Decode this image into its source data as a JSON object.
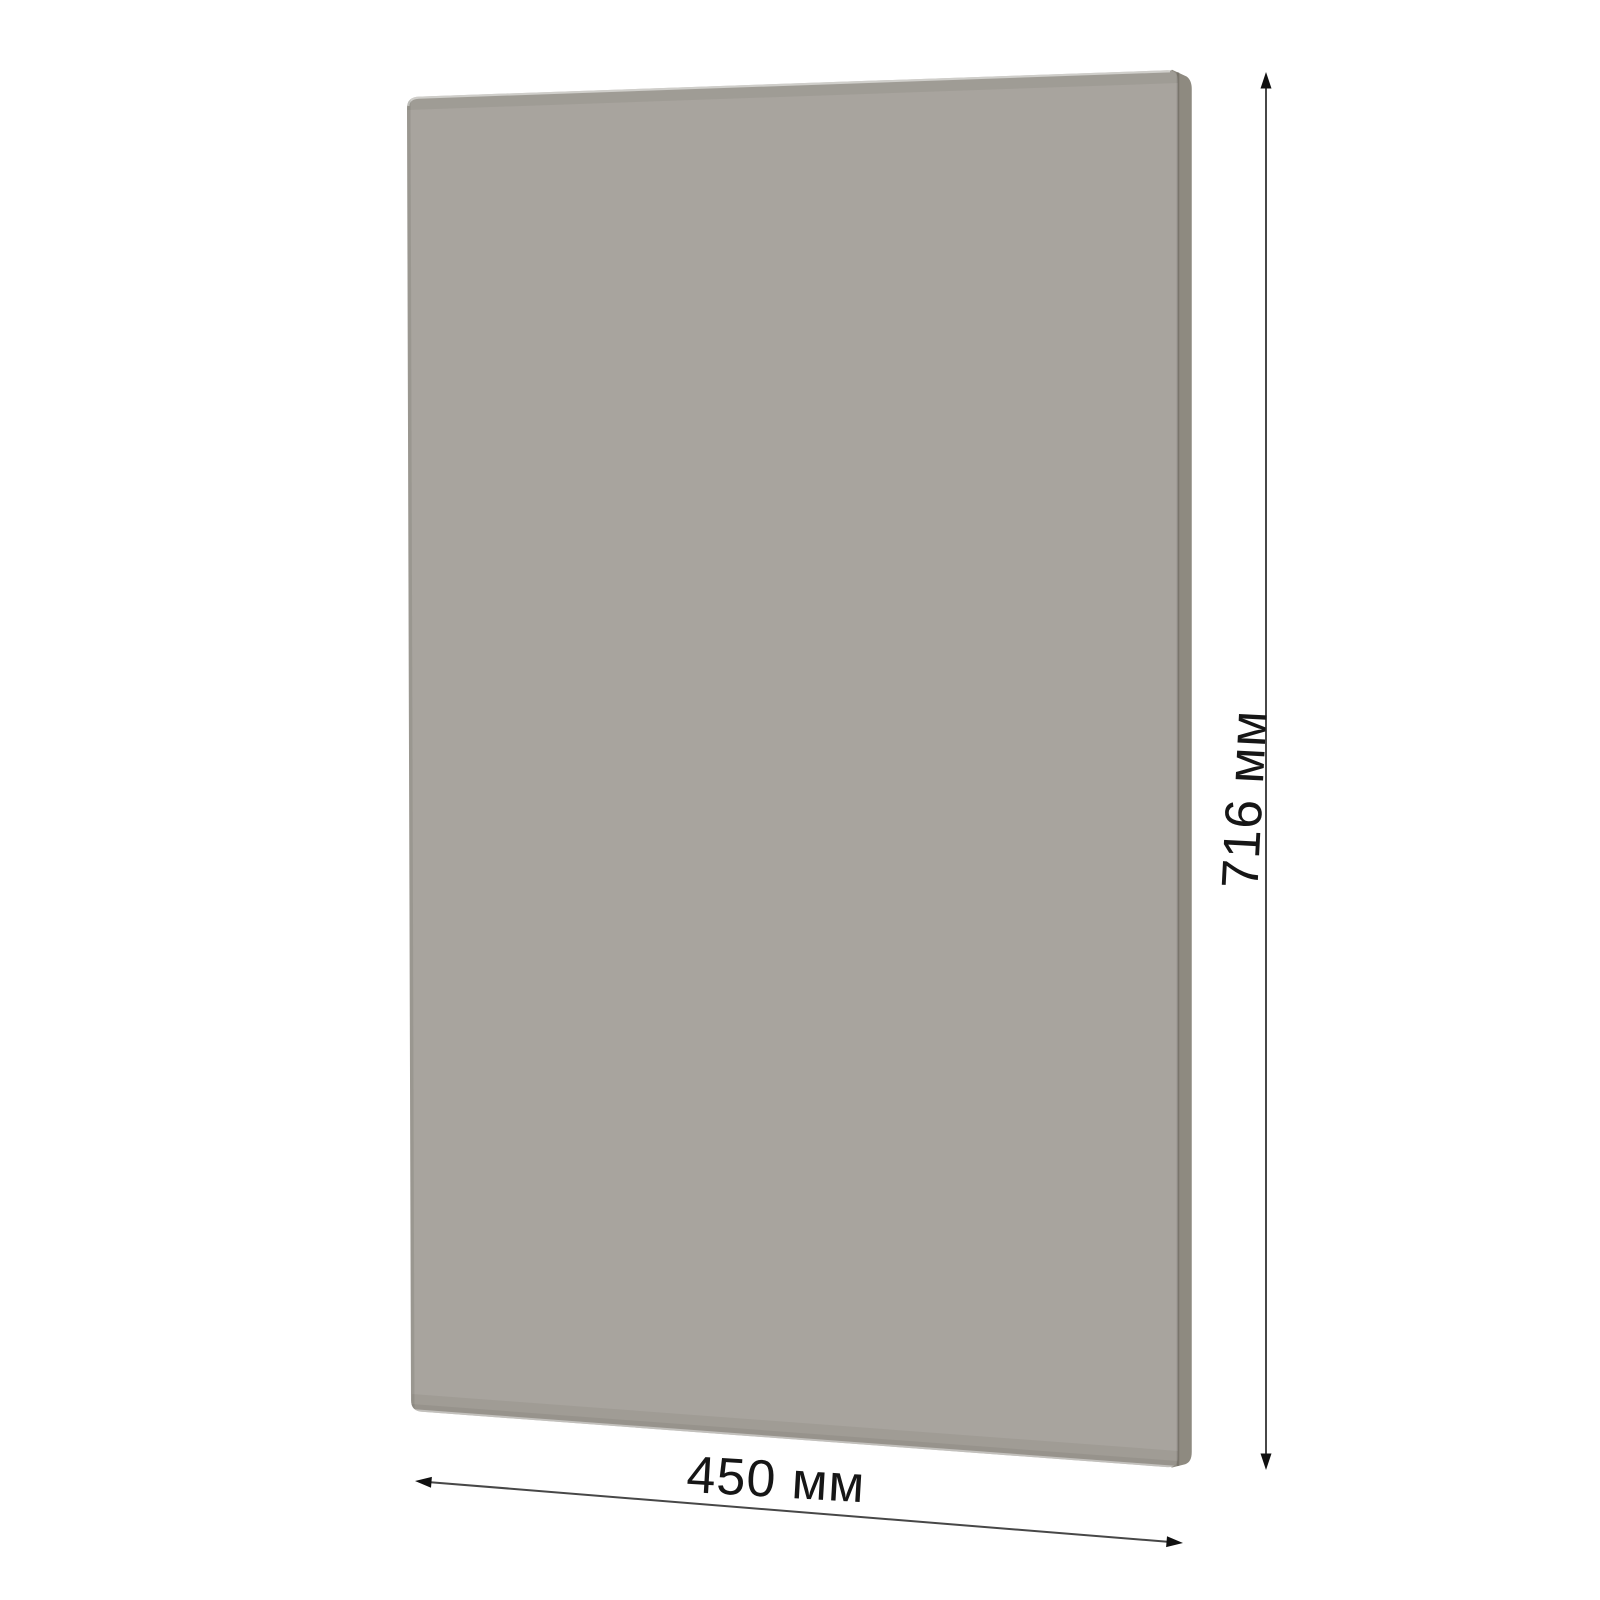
{
  "page": {
    "background_color": "#ffffff",
    "description_label": "Panel dimension drawing"
  },
  "panel": {
    "face_color": "#a8a49e",
    "side_color": "#8e8a80"
  },
  "dimensions": {
    "height": {
      "label": "716 мм",
      "value": 716,
      "unit": "мм"
    },
    "width": {
      "label": "450 мм",
      "value": 450,
      "unit": "мм"
    }
  },
  "dimension_style": {
    "line_color": "#474747",
    "arrow_color": "#101010",
    "label_color": "#161616"
  }
}
